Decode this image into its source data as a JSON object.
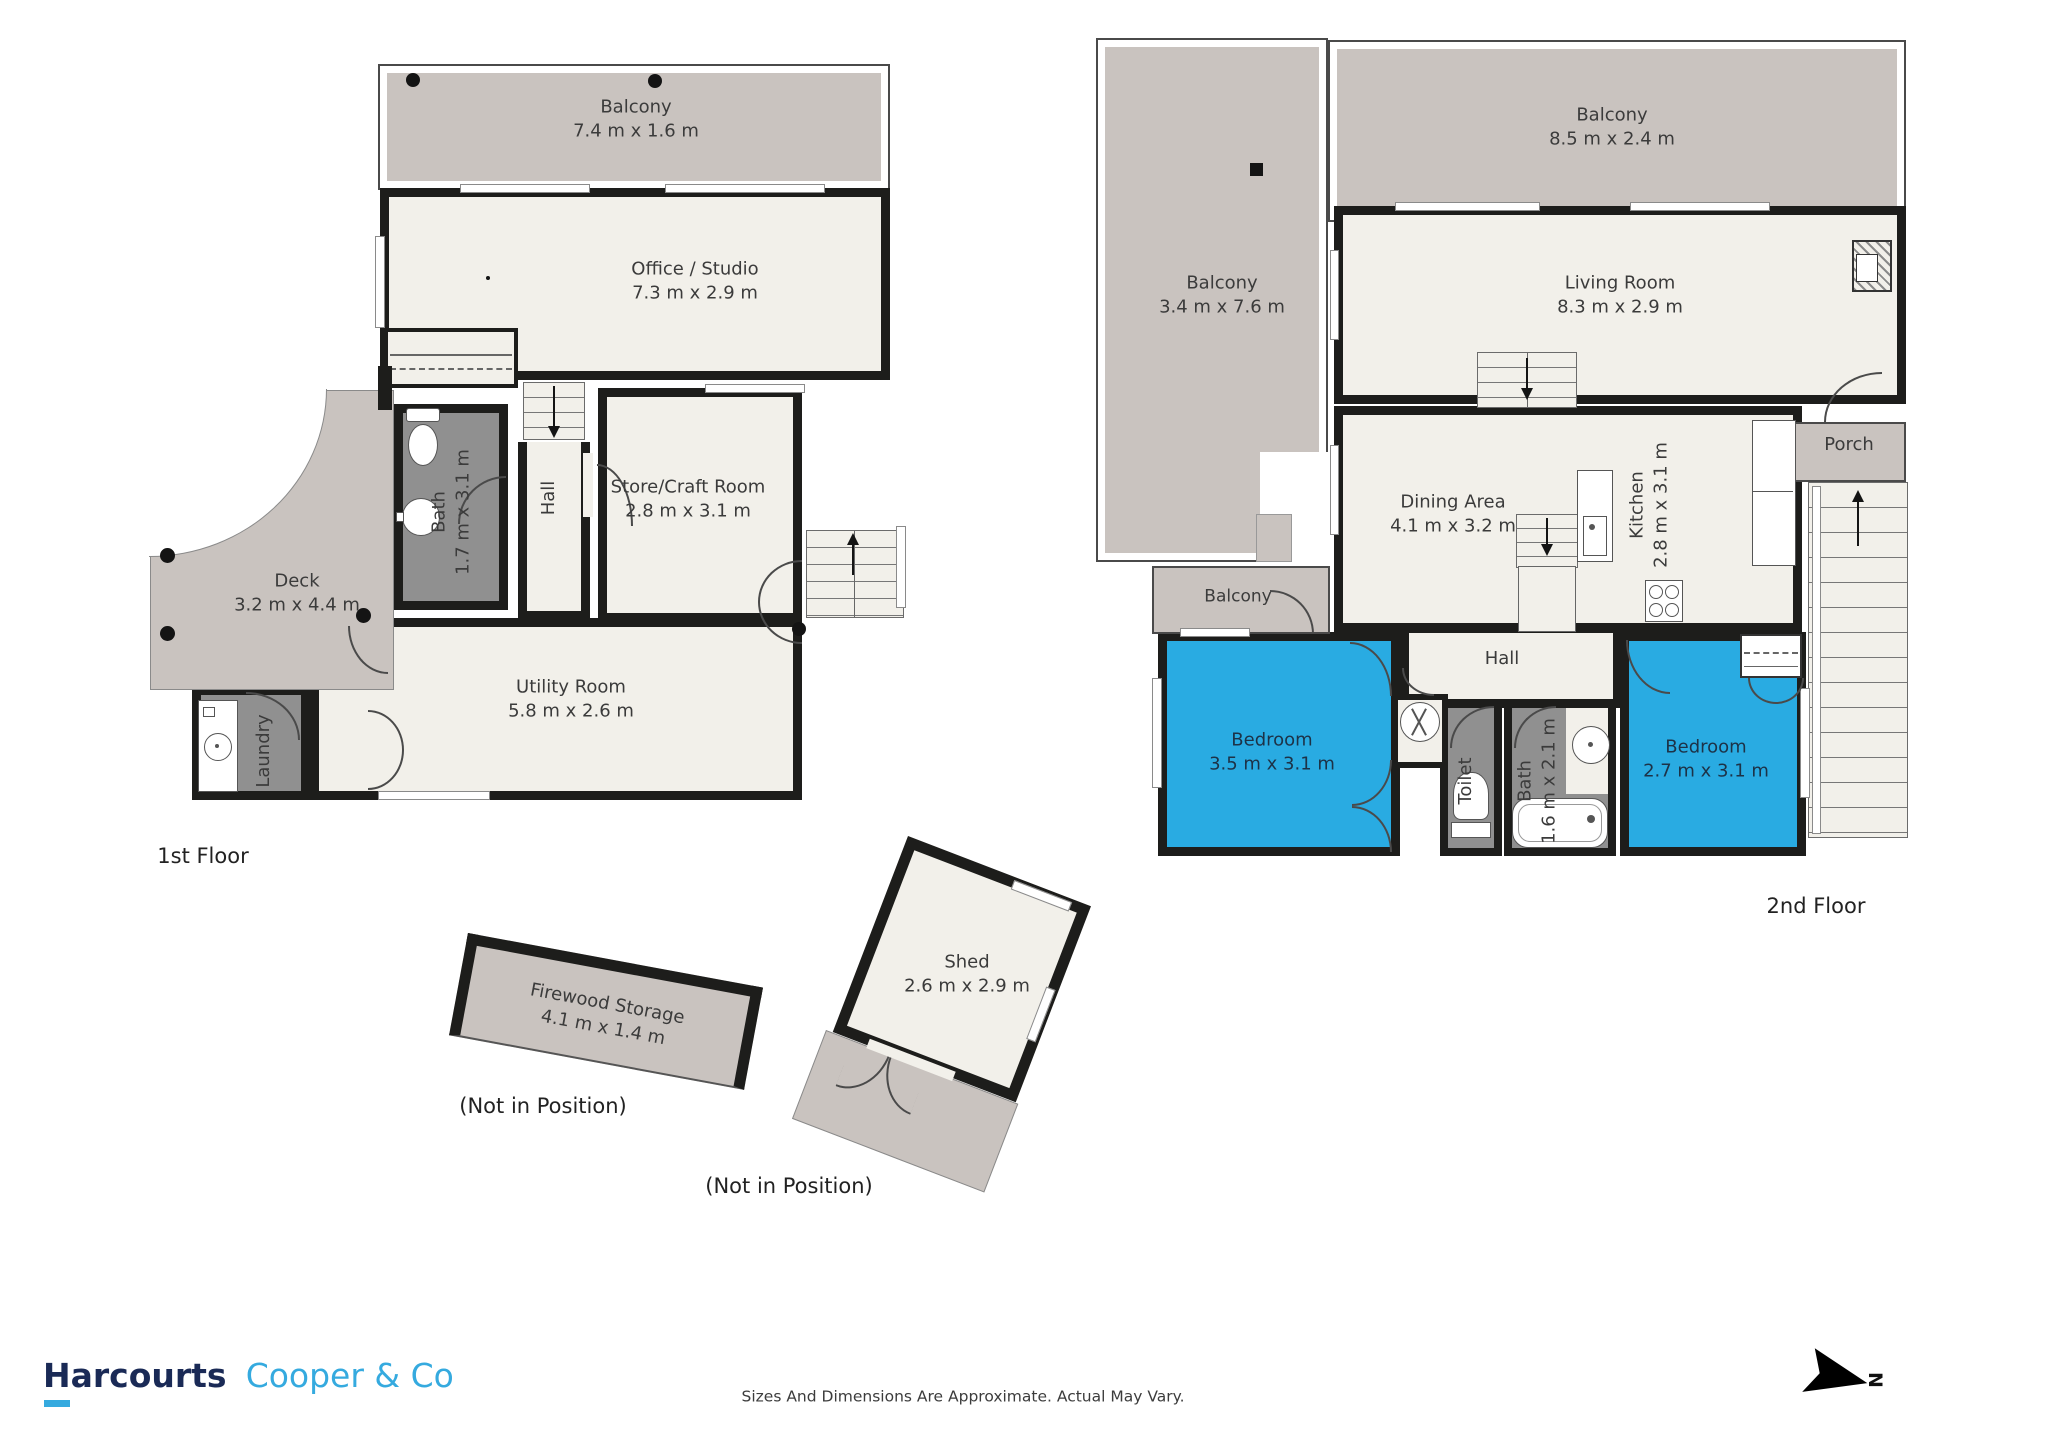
{
  "floors": {
    "first": {
      "label": "1st Floor",
      "balcony": {
        "name": "Balcony",
        "dims": "7.4 m x 1.6 m"
      },
      "office": {
        "name": "Office / Studio",
        "dims": "7.3 m x 2.9 m"
      },
      "bath": {
        "name": "Bath",
        "dims": "1.7 m x 3.1 m"
      },
      "hall": {
        "name": "Hall"
      },
      "store": {
        "name": "Store/Craft Room",
        "dims": "2.8 m x 3.1 m"
      },
      "deck": {
        "name": "Deck",
        "dims": "3.2 m x 4.4 m"
      },
      "laundry": {
        "name": "Laundry"
      },
      "utility": {
        "name": "Utility Room",
        "dims": "5.8 m x 2.6 m"
      }
    },
    "second": {
      "label": "2nd Floor",
      "balcony_top": {
        "name": "Balcony",
        "dims": "8.5 m x 2.4 m"
      },
      "balcony_side": {
        "name": "Balcony",
        "dims": "3.4 m x 7.6 m"
      },
      "balcony_small": {
        "name": "Balcony"
      },
      "living": {
        "name": "Living Room",
        "dims": "8.3 m x 2.9 m"
      },
      "dining": {
        "name": "Dining Area",
        "dims": "4.1 m x 3.2 m"
      },
      "kitchen": {
        "name": "Kitchen",
        "dims": "2.8 m x 3.1 m"
      },
      "porch": {
        "name": "Porch"
      },
      "hall": {
        "name": "Hall"
      },
      "bedroom1": {
        "name": "Bedroom",
        "dims": "3.5 m x 3.1 m"
      },
      "bedroom2": {
        "name": "Bedroom",
        "dims": "2.7 m x 3.1 m"
      },
      "toilet": {
        "name": "Toilet"
      },
      "bath": {
        "name": "Bath",
        "dims": "1.6 m x 2.1 m"
      }
    }
  },
  "outbuildings": {
    "firewood": {
      "name": "Firewood Storage",
      "dims": "4.1 m x 1.4 m",
      "note": "(Not in Position)"
    },
    "shed": {
      "name": "Shed",
      "dims": "2.6 m x 2.9 m",
      "note": "(Not in Position)"
    }
  },
  "footer": {
    "brand_primary": "Harcourts",
    "brand_secondary": "Cooper & Co",
    "disclaimer": "Sizes And Dimensions Are Approximate. Actual May Vary.",
    "compass": "N"
  },
  "colors": {
    "wall": "#1d1d1b",
    "floor": "#f2f0ea",
    "outdoor_gray": "#c9c3bf",
    "wet_room_gray": "#909090",
    "bedroom_blue": "#29abe2",
    "brand_navy": "#1a2a56",
    "brand_blue": "#35aadf"
  }
}
